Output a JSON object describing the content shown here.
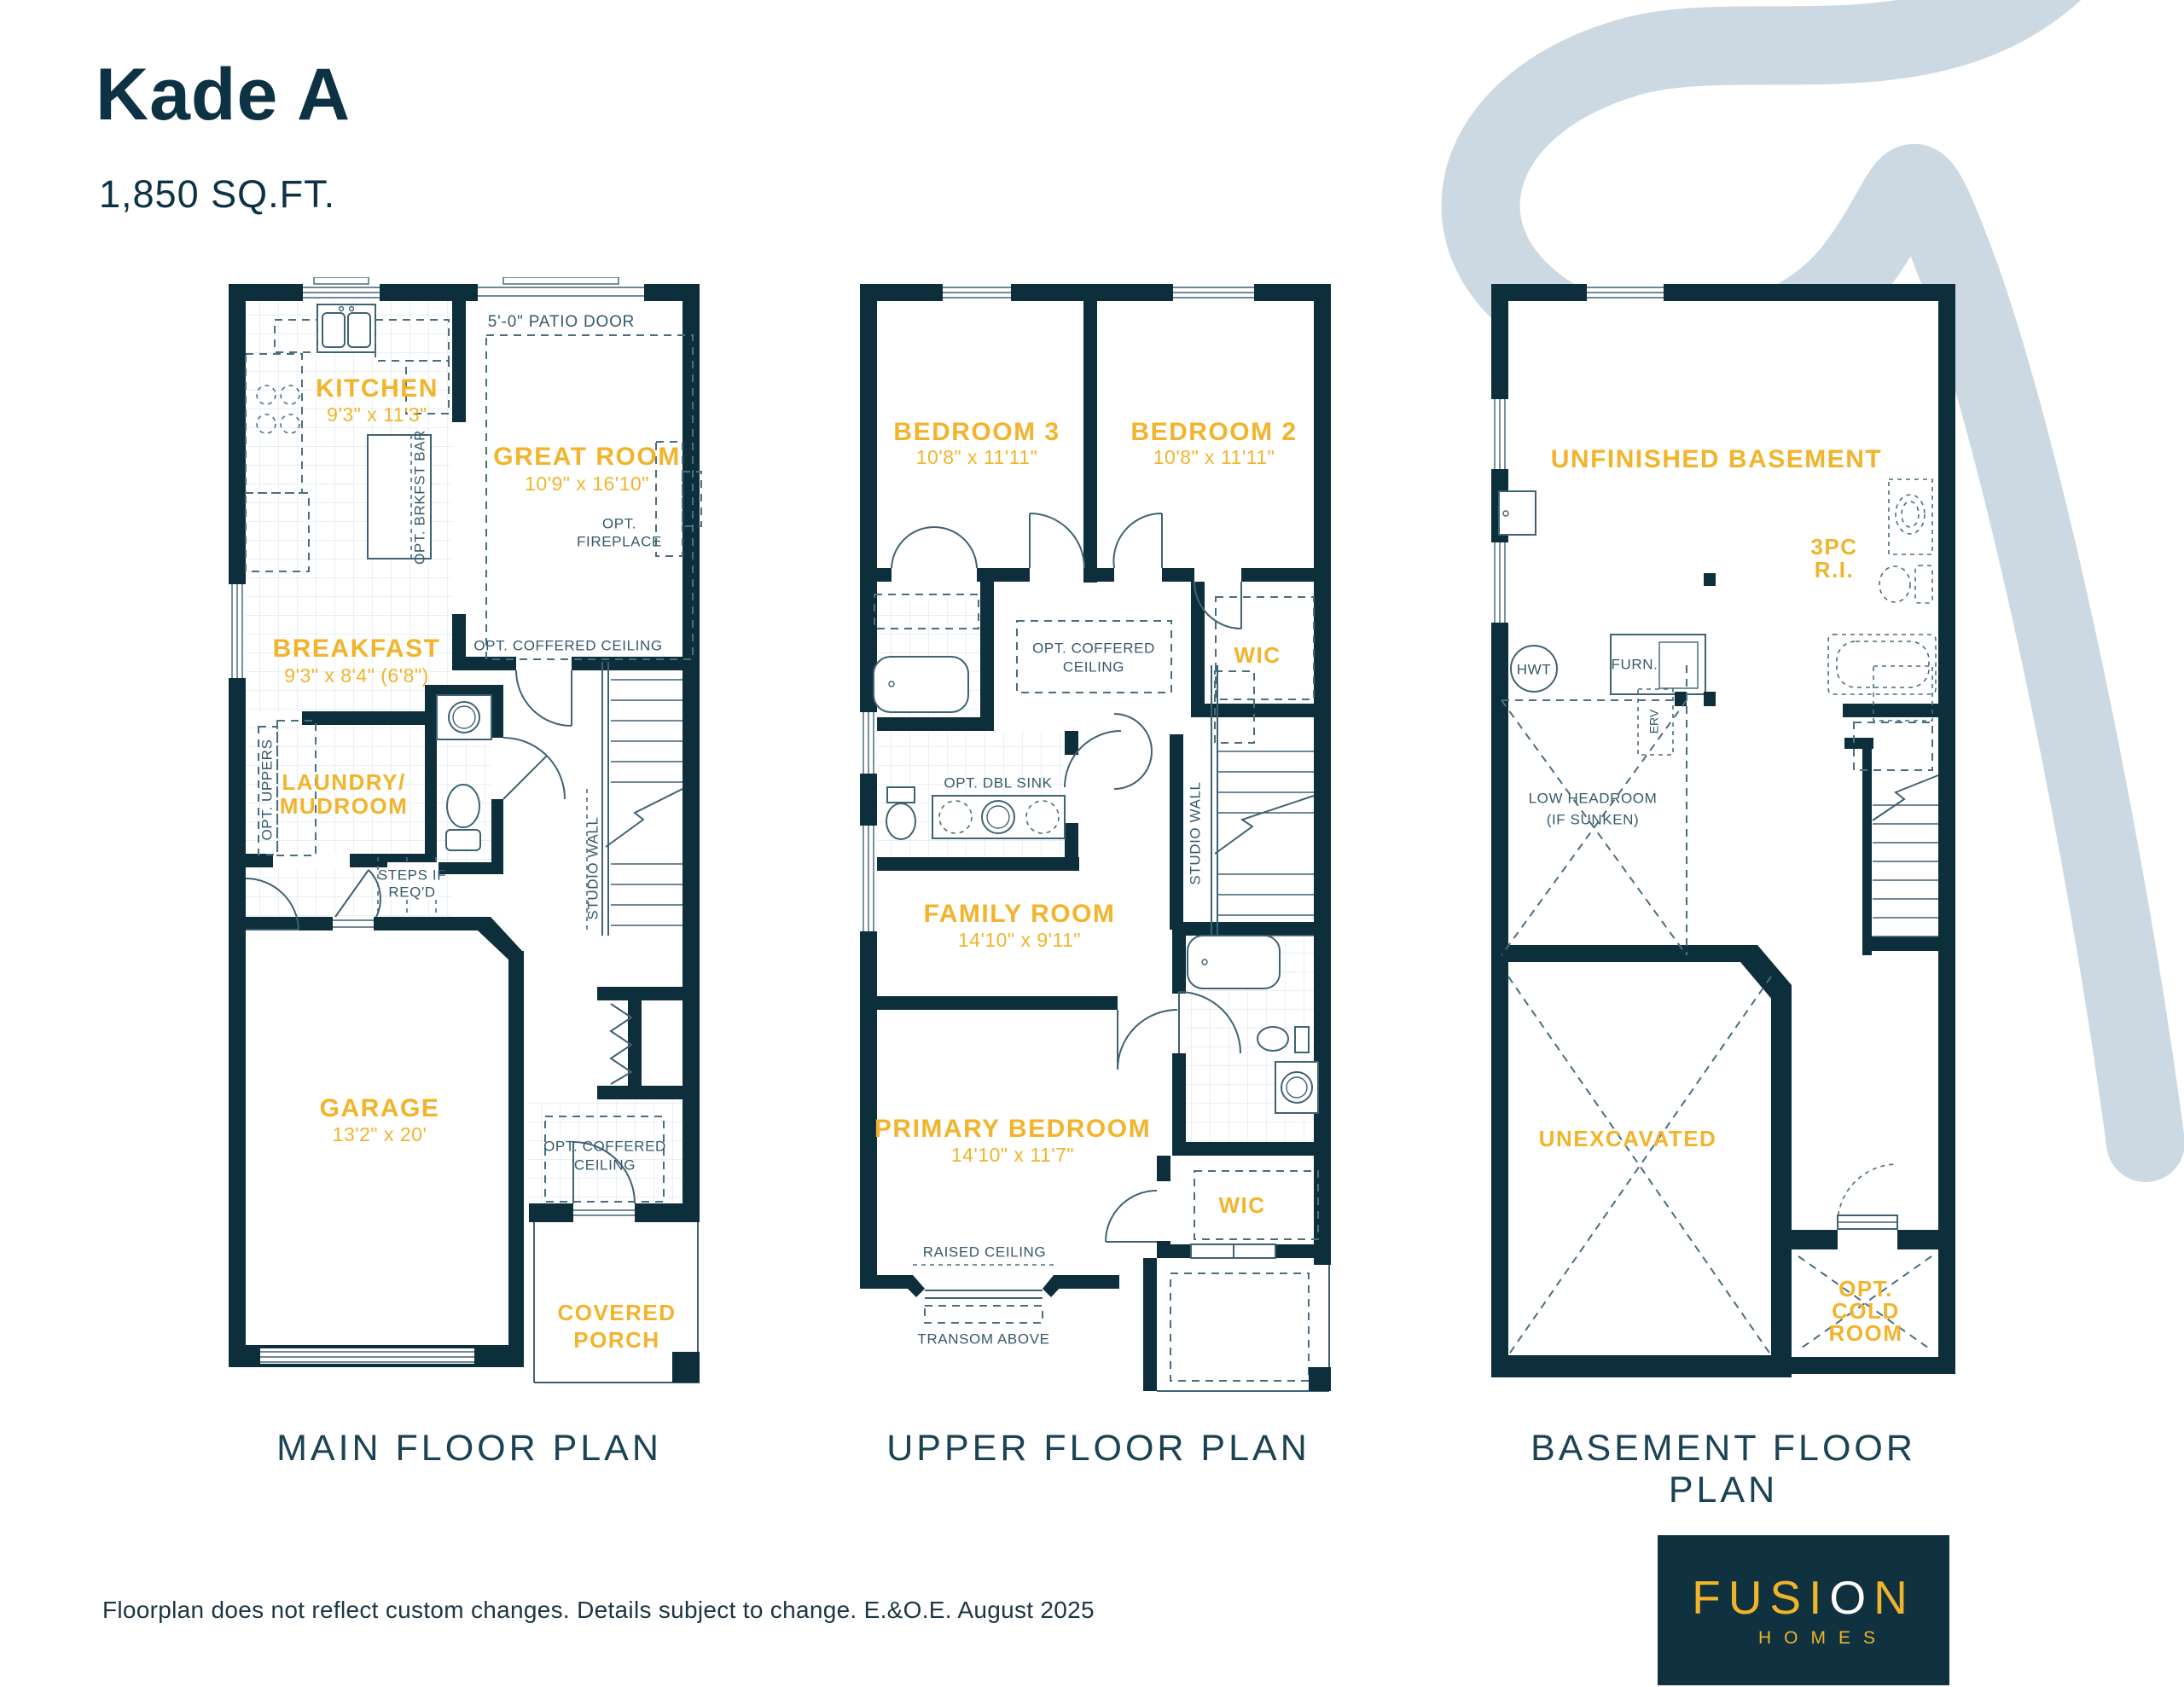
{
  "header": {
    "title": "Kade A",
    "sqft": "1,850 SQ.FT."
  },
  "main": {
    "caption": "MAIN FLOOR PLAN",
    "kitchen": "KITCHEN",
    "kitchen_dims": "9'3\" x 11'3\"",
    "great_room": "GREAT ROOM",
    "great_room_dims": "10'9\" x 16'10\"",
    "breakfast": "BREAKFAST",
    "breakfast_dims": "9'3\" x 8'4\" (6'8\")",
    "laundry1": "LAUNDRY/",
    "laundry2": "MUDROOM",
    "garage": "GARAGE",
    "garage_dims": "13'2\" x 20'",
    "porch1": "COVERED",
    "porch2": "PORCH",
    "patio_door": "5'-0\" PATIO DOOR",
    "opt_fireplace1": "OPT.",
    "opt_fireplace2": "FIREPLACE",
    "opt_coffered": "OPT. COFFERED CEILING",
    "opt_brkfst_bar": "OPT. BRKFST BAR",
    "opt_uppers": "OPT. UPPERS",
    "steps1": "STEPS IF",
    "steps2": "REQ'D",
    "studio_wall": "STUDIO WALL",
    "foyer_coffered1": "OPT. COFFERED",
    "foyer_coffered2": "CEILING"
  },
  "upper": {
    "caption": "UPPER FLOOR PLAN",
    "bedroom3": "BEDROOM 3",
    "bedroom3_dims": "10'8\" x 11'11\"",
    "bedroom2": "BEDROOM 2",
    "bedroom2_dims": "10'8\" x 11'11\"",
    "coffered1": "OPT. COFFERED",
    "coffered2": "CEILING",
    "wic": "WIC",
    "dbl_sink": "OPT. DBL SINK",
    "family": "FAMILY ROOM",
    "family_dims": "14'10\" x 9'11\"",
    "studio_wall": "STUDIO WALL",
    "primary": "PRIMARY BEDROOM",
    "primary_dims": "14'10\" x 11'7\"",
    "wic2": "WIC",
    "raised_ceiling": "RAISED CEILING",
    "transom": "TRANSOM ABOVE"
  },
  "basement": {
    "caption": "BASEMENT FLOOR PLAN",
    "unfinished": "UNFINISHED BASEMENT",
    "threepc1": "3PC",
    "threepc2": "R.I.",
    "hwt": "HWT",
    "furn": "FURN.",
    "erv": "ERV",
    "low1": "LOW HEADROOM",
    "low2": "(IF SUNKEN)",
    "unexcavated": "UNEXCAVATED",
    "cold1": "OPT.",
    "cold2": "COLD",
    "cold3": "ROOM"
  },
  "footer": {
    "disclaimer": "Floorplan does not reflect custom changes. Details subject to change. E.&O.E. August 2025"
  },
  "logo": {
    "fusi": "FUSI",
    "o": "O",
    "n": "N",
    "homes": "HOMES"
  },
  "colors": {
    "wall": "#0d2e3b",
    "accent": "#f1b42c",
    "swoosh": "#cdd9e2",
    "navy_text": "#1b4354"
  }
}
